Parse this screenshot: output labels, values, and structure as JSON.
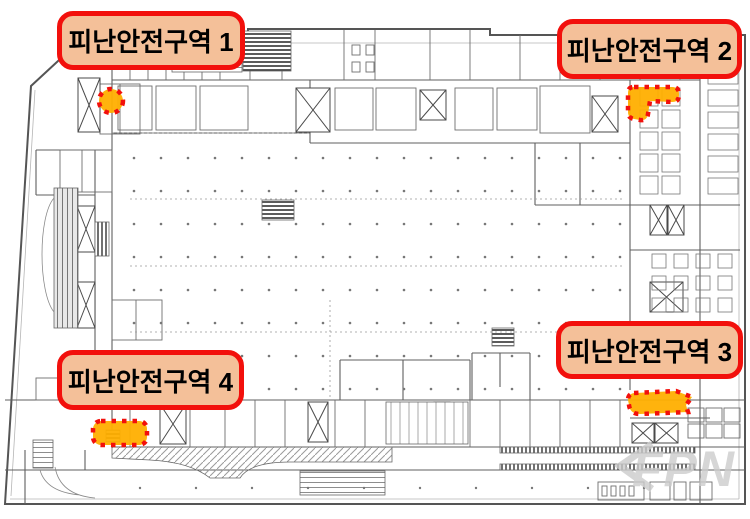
{
  "figure": {
    "kind": "building floor plan with highlighted evacuation safety zones"
  },
  "labels": [
    {
      "id": "zone-1",
      "text": "피난안전구역 1"
    },
    {
      "id": "zone-2",
      "text": "피난안전구역 2"
    },
    {
      "id": "zone-3",
      "text": "피난안전구역 3"
    },
    {
      "id": "zone-4",
      "text": "피난안전구역 4"
    }
  ],
  "markers": [
    {
      "zone": "피난안전구역 1"
    },
    {
      "zone": "피난안전구역 2"
    },
    {
      "zone": "피난안전구역 3"
    },
    {
      "zone": "피난안전구역 4"
    }
  ],
  "watermark": {
    "text": "FPN"
  },
  "colors": {
    "label_bg": "#f4c099",
    "label_border": "#f2100c",
    "label_text": "#000000",
    "marker_fill": "#ffaf00",
    "marker_stroke": "#f2100c",
    "plan_line": "#5f5f5f",
    "plan_line_light": "#9a9a9a",
    "watermark": "#cccccc"
  }
}
